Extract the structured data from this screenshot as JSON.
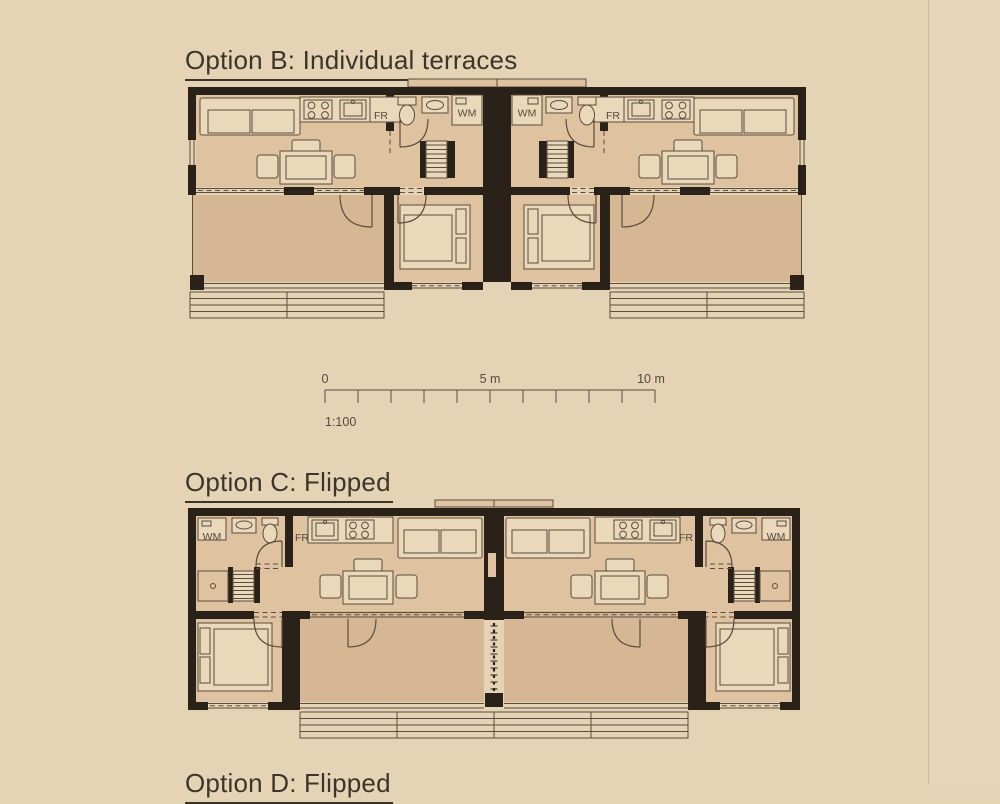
{
  "page": {
    "background": "#e5d3b6"
  },
  "colors": {
    "bg": "#e5d3b6",
    "wall": "#2a2218",
    "floor": "#dfc2a0",
    "terrace": "#d5b893",
    "furn": "#ead8ba",
    "line": "#5b4d3d",
    "title": "#3e352a",
    "label": "#564a3a"
  },
  "sections": [
    {
      "id": "option-b",
      "title": "Option B: Individual terraces"
    },
    {
      "id": "option-c",
      "title": "Option C: Flipped"
    },
    {
      "id": "option-d",
      "title": "Option D: Flipped"
    }
  ],
  "plan_labels": {
    "fridge": "FR",
    "washing_machine": "WM"
  },
  "scale_bar": {
    "start": "0",
    "middle": "5 m",
    "end": "10 m",
    "ratio": "1:100"
  }
}
